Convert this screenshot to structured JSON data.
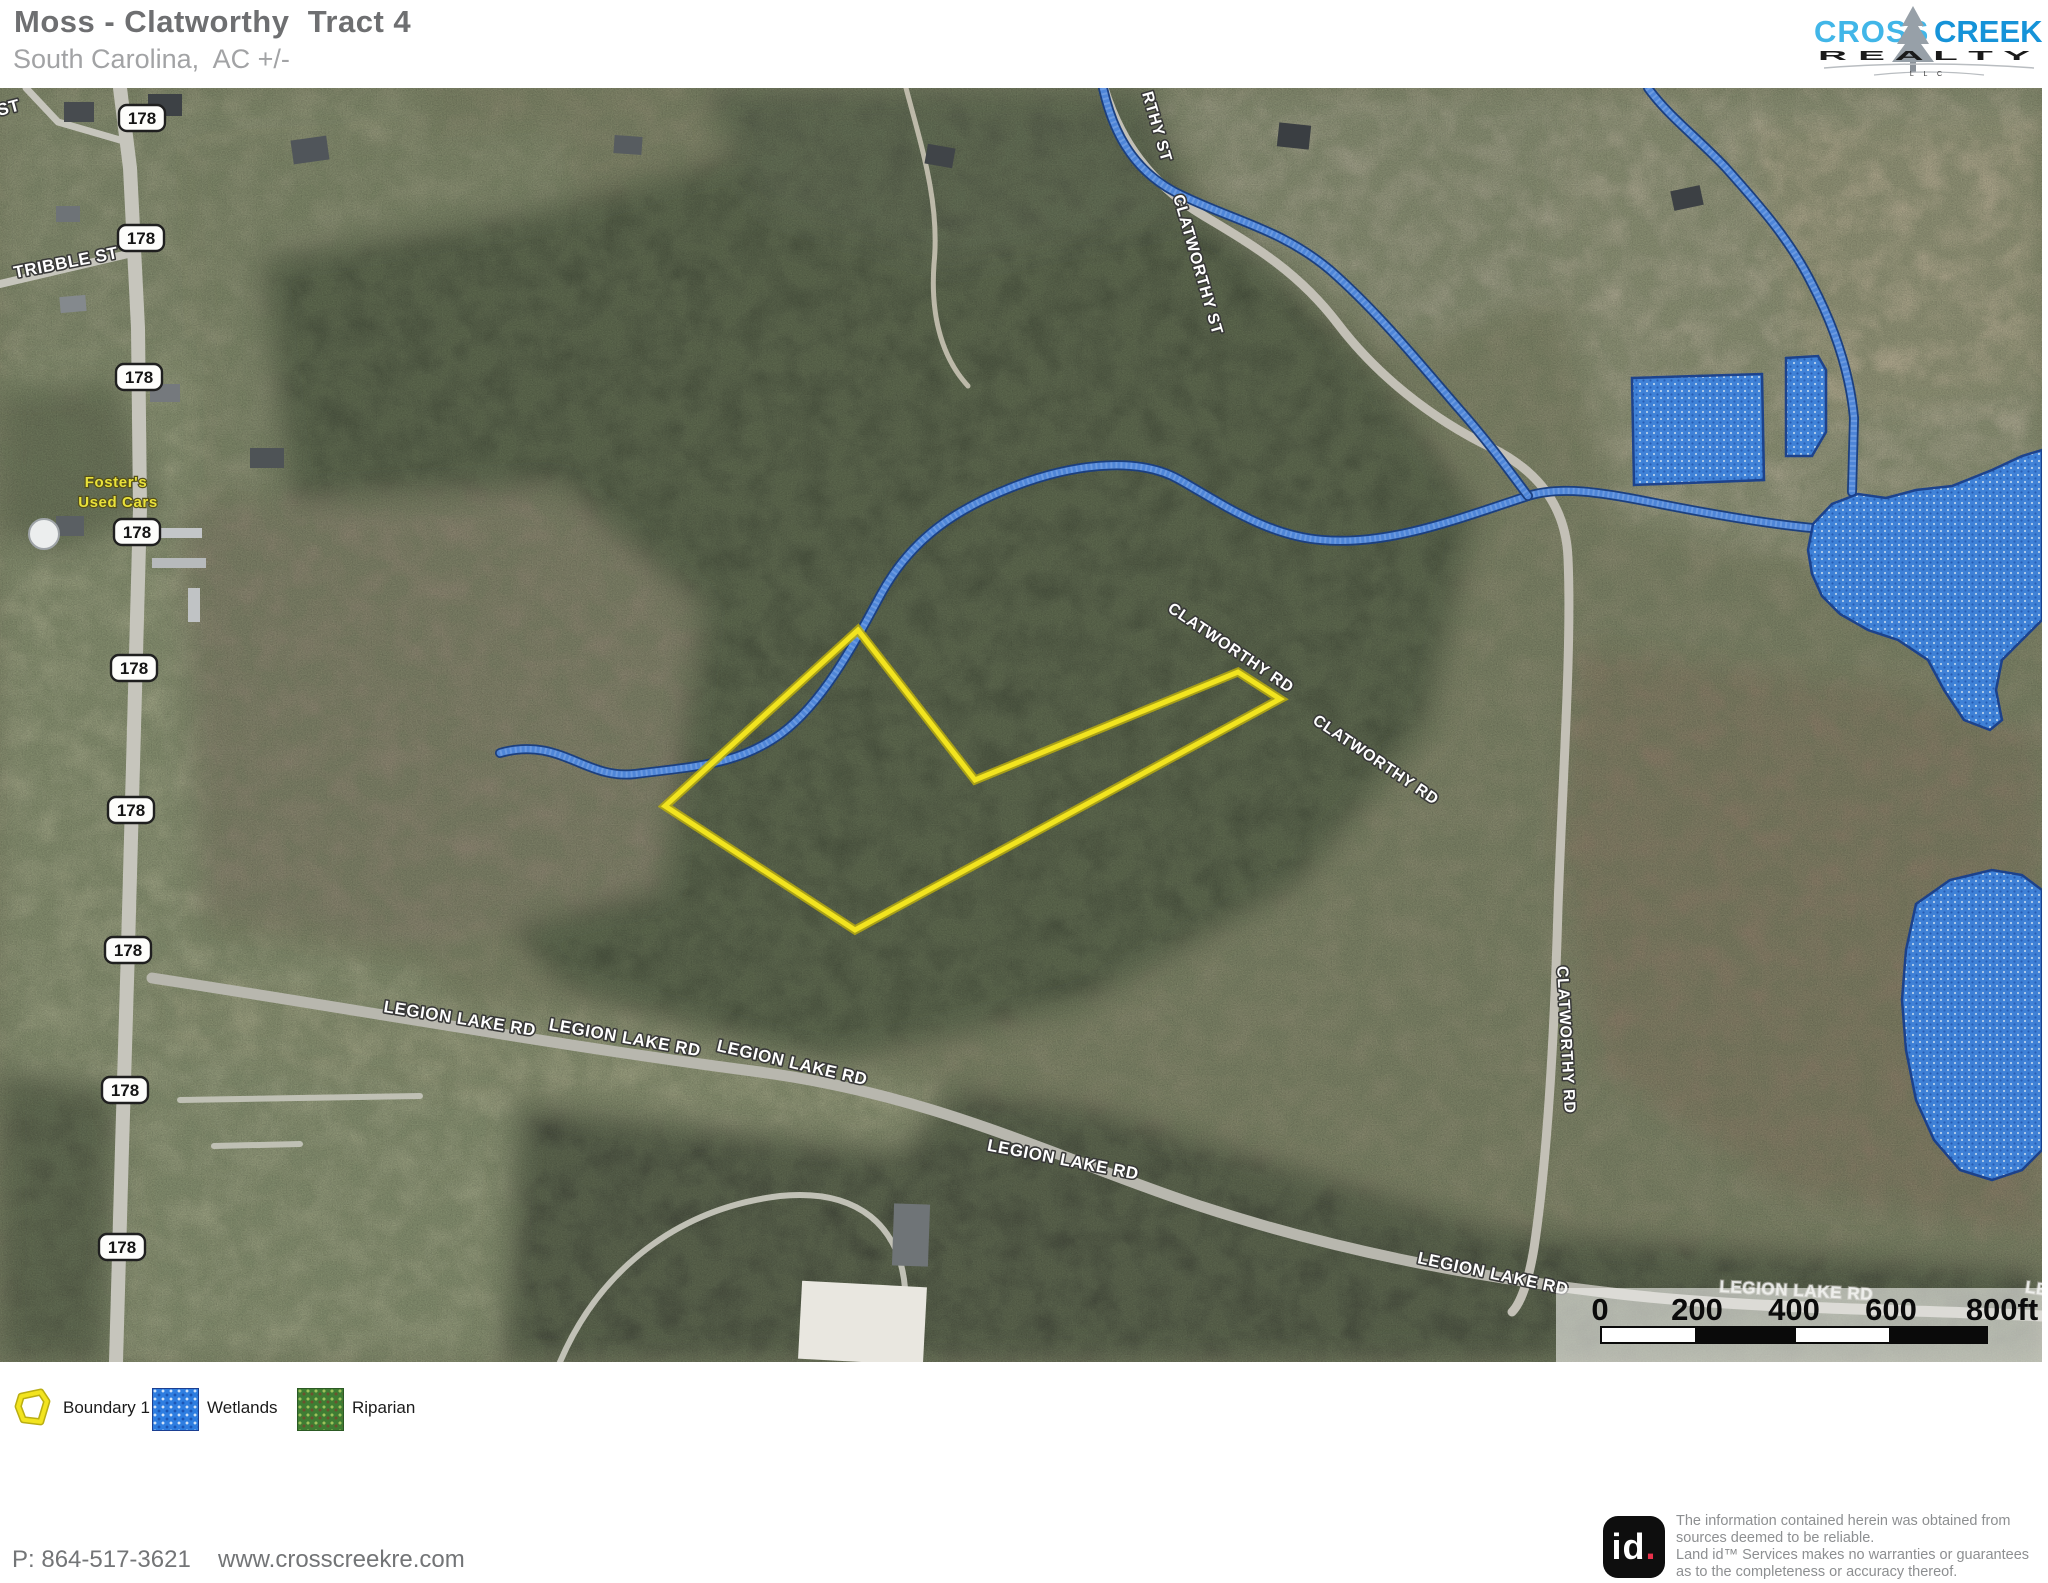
{
  "header": {
    "title": "Moss - Clatworthy  Tract 4",
    "subtitle": "South Carolina,  AC +/-"
  },
  "logo": {
    "cross": "CROSS",
    "creek": "CREEK",
    "realty": "R  E  A  L  T  Y",
    "llc": "L L C"
  },
  "colors": {
    "boundary": "#f2e41f",
    "boundary_casing": "#b7ab10",
    "wetland_fill": "#3b82e0",
    "wetland_stroke": "#163e8f",
    "stream": "#4f86d8",
    "stream_dark": "#1c3f7e",
    "riparian_fill": "#3f7d33",
    "logo_cross": "#41b6e8",
    "logo_creek": "#1693d8",
    "title_color": "#6e6f71",
    "subtitle_color": "#a2a3a5"
  },
  "map": {
    "route_shield": "178",
    "shield_positions": [
      [
        142,
        30
      ],
      [
        141,
        150
      ],
      [
        139,
        289
      ],
      [
        137,
        444
      ],
      [
        134,
        580
      ],
      [
        131,
        722
      ],
      [
        128,
        862
      ],
      [
        125,
        1002
      ],
      [
        122,
        1159
      ]
    ],
    "terrain": [
      {
        "pts": [
          [
            0,
            0
          ],
          [
            2042,
            0
          ],
          [
            2042,
            1274
          ],
          [
            0,
            1274
          ]
        ],
        "fill": "#8a8a70"
      },
      {
        "pts": [
          [
            0,
            0
          ],
          [
            195,
            0
          ],
          [
            205,
            640
          ],
          [
            190,
            1274
          ],
          [
            0,
            1274
          ]
        ],
        "fill": "#9da283"
      },
      {
        "pts": [
          [
            0,
            0
          ],
          [
            420,
            0
          ],
          [
            430,
            180
          ],
          [
            240,
            260
          ],
          [
            0,
            280
          ]
        ],
        "fill": "#94987b"
      },
      {
        "pts": [
          [
            190,
            60
          ],
          [
            560,
            40
          ],
          [
            620,
            300
          ],
          [
            400,
            420
          ],
          [
            210,
            400
          ]
        ],
        "fill": "#8f9377"
      },
      {
        "pts": [
          [
            0,
            300
          ],
          [
            120,
            290
          ],
          [
            160,
            420
          ],
          [
            60,
            470
          ],
          [
            0,
            450
          ]
        ],
        "fill": "#6a7158"
      },
      {
        "pts": [
          [
            260,
            170
          ],
          [
            540,
            120
          ],
          [
            760,
            60
          ],
          [
            980,
            140
          ],
          [
            1120,
            60
          ],
          [
            1260,
            160
          ],
          [
            1380,
            280
          ],
          [
            1480,
            420
          ],
          [
            1430,
            640
          ],
          [
            1300,
            800
          ],
          [
            1080,
            920
          ],
          [
            820,
            980
          ],
          [
            560,
            900
          ],
          [
            380,
            700
          ],
          [
            290,
            430
          ]
        ],
        "fill": "#4e5643"
      },
      {
        "pts": [
          [
            700,
            0
          ],
          [
            1150,
            0
          ],
          [
            1200,
            130
          ],
          [
            950,
            180
          ],
          [
            760,
            120
          ]
        ],
        "fill": "#59614e"
      },
      {
        "pts": [
          [
            1150,
            0
          ],
          [
            1620,
            0
          ],
          [
            1640,
            180
          ],
          [
            1400,
            260
          ],
          [
            1230,
            140
          ]
        ],
        "fill": "#a1a089"
      },
      {
        "pts": [
          [
            1560,
            0
          ],
          [
            2042,
            0
          ],
          [
            2042,
            430
          ],
          [
            1800,
            470
          ],
          [
            1620,
            430
          ],
          [
            1560,
            200
          ]
        ],
        "fill": "#a8a58d"
      },
      {
        "pts": [
          [
            1750,
            40
          ],
          [
            2042,
            30
          ],
          [
            2042,
            300
          ],
          [
            1820,
            330
          ]
        ],
        "fill": "#b2aa90"
      },
      {
        "pts": [
          [
            180,
            420
          ],
          [
            560,
            400
          ],
          [
            700,
            520
          ],
          [
            660,
            800
          ],
          [
            420,
            860
          ],
          [
            200,
            820
          ]
        ],
        "fill": "#8d8672"
      },
      {
        "pts": [
          [
            1580,
            560
          ],
          [
            1900,
            600
          ],
          [
            2042,
            650
          ],
          [
            2042,
            1150
          ],
          [
            1780,
            1100
          ],
          [
            1600,
            980
          ],
          [
            1560,
            760
          ]
        ],
        "fill": "#8b7e69"
      },
      {
        "pts": [
          [
            340,
            1000
          ],
          [
            700,
            960
          ],
          [
            1100,
            1020
          ],
          [
            1500,
            1140
          ],
          [
            2042,
            1180
          ],
          [
            2042,
            1274
          ],
          [
            360,
            1274
          ],
          [
            300,
            1120
          ]
        ],
        "fill": "#485040"
      },
      {
        "pts": [
          [
            140,
            840
          ],
          [
            420,
            880
          ],
          [
            520,
            980
          ],
          [
            500,
            1274
          ],
          [
            150,
            1274
          ]
        ],
        "fill": "#9ba182"
      },
      {
        "pts": [
          [
            150,
            880
          ],
          [
            600,
            930
          ],
          [
            950,
            1000
          ],
          [
            900,
            1060
          ],
          [
            500,
            1010
          ],
          [
            160,
            950
          ]
        ],
        "fill": "#a0a384"
      },
      {
        "pts": [
          [
            0,
            980
          ],
          [
            120,
            1000
          ],
          [
            110,
            1274
          ],
          [
            0,
            1274
          ]
        ],
        "fill": "#565d4a"
      }
    ],
    "roads": [
      {
        "d": "M120,0 L130,80 L138,240 L140,420 L134,640 L128,860 L122,1060 L116,1274",
        "w": 14,
        "c": "#c6c5bc"
      },
      {
        "d": "M152,890 C360,922 560,958 760,984 C940,1008 1060,1072 1200,1118 C1340,1164 1480,1190 1620,1206 C1760,1222 1940,1222 2042,1228",
        "w": 11,
        "c": "#b8b7ae"
      },
      {
        "d": "M1104,0 C1120,52 1150,96 1204,128 C1258,160 1300,186 1338,236 C1376,286 1430,330 1492,360 C1540,384 1566,420 1568,470 C1572,560 1562,700 1558,820 C1554,960 1546,1080 1534,1160 C1528,1196 1520,1216 1512,1224",
        "w": 9,
        "c": "#c3c0b6"
      },
      {
        "d": "M0,196 L128,166",
        "w": 8,
        "c": "#c6c5bc"
      },
      {
        "d": "M26,0 L58,34 L120,52",
        "w": 7,
        "c": "#c6c5bc"
      },
      {
        "d": "M560,1274 C600,1180 680,1120 780,1108 C860,1100 900,1140 905,1200",
        "w": 6,
        "c": "#cdccc2",
        "op": 0.9
      },
      {
        "d": "M906,0 C922,60 940,116 934,176 C930,232 944,272 968,298",
        "w": 5,
        "c": "#cfc9ba",
        "op": 0.85
      },
      {
        "d": "M180,1012 L420,1008 M214,1058 L300,1056",
        "w": 6,
        "c": "#c7c6bd",
        "op": 0.9
      }
    ],
    "buildings": [
      [
        64,
        14,
        30,
        20,
        0,
        "#474b4f"
      ],
      [
        148,
        6,
        34,
        22,
        0,
        "#3d4145"
      ],
      [
        292,
        50,
        36,
        24,
        -8,
        "#50555a"
      ],
      [
        614,
        48,
        28,
        18,
        4,
        "#575c60"
      ],
      [
        926,
        58,
        28,
        20,
        10,
        "#404448"
      ],
      [
        1278,
        36,
        32,
        24,
        6,
        "#3a3e42"
      ],
      [
        56,
        118,
        24,
        16,
        0,
        "#6e7377"
      ],
      [
        150,
        296,
        30,
        18,
        0,
        "#75797d"
      ],
      [
        60,
        208,
        26,
        16,
        -5,
        "#84898d"
      ],
      [
        56,
        428,
        28,
        20,
        0,
        "#5a5f63"
      ],
      [
        250,
        360,
        34,
        20,
        0,
        "#4e5356"
      ],
      [
        1672,
        100,
        30,
        20,
        -12,
        "#3c4044"
      ],
      [
        800,
        1196,
        125,
        78,
        3,
        "#e9e7e0"
      ],
      [
        893,
        1116,
        36,
        62,
        2,
        "#6f7477"
      ],
      [
        150,
        440,
        52,
        10,
        0,
        "#c3c6c8"
      ],
      [
        152,
        470,
        54,
        10,
        0,
        "#b7babc"
      ],
      [
        188,
        500,
        12,
        34,
        0,
        "#c0c3c5"
      ]
    ],
    "water_tower": [
      44,
      446,
      15
    ],
    "streams": [
      "M500,665 C560,648 585,692 635,686 C700,678 740,676 782,645 C822,615 852,560 880,508 C912,448 960,420 1010,400 C1065,378 1135,366 1180,392 C1222,416 1268,448 1322,452 C1390,458 1460,430 1528,408 C1560,398 1600,404 1650,414 C1710,426 1770,436 1812,440",
      "M1103,0 C1112,40 1130,80 1175,104 C1230,132 1280,140 1330,182 C1380,226 1420,276 1460,322 C1490,356 1510,384 1528,408",
      "M1648,0 C1668,28 1700,52 1726,80 C1760,118 1790,152 1812,196 C1836,242 1850,286 1854,330 L1852,404"
    ],
    "wetlands": [
      [
        [
          1632,
          290
        ],
        [
          1762,
          286
        ],
        [
          1764,
          392
        ],
        [
          1634,
          397
        ]
      ],
      [
        [
          1786,
          270
        ],
        [
          1818,
          268
        ],
        [
          1826,
          282
        ],
        [
          1826,
          344
        ],
        [
          1812,
          368
        ],
        [
          1786,
          368
        ]
      ],
      [
        [
          1808,
          462
        ],
        [
          1813,
          436
        ],
        [
          1832,
          416
        ],
        [
          1858,
          406
        ],
        [
          1886,
          410
        ],
        [
          1916,
          402
        ],
        [
          1952,
          398
        ],
        [
          1992,
          382
        ],
        [
          2022,
          368
        ],
        [
          2042,
          362
        ],
        [
          2042,
          532
        ],
        [
          2022,
          552
        ],
        [
          2002,
          572
        ],
        [
          1996,
          602
        ],
        [
          2002,
          632
        ],
        [
          1990,
          642
        ],
        [
          1964,
          632
        ],
        [
          1944,
          602
        ],
        [
          1928,
          572
        ],
        [
          1898,
          552
        ],
        [
          1868,
          542
        ],
        [
          1840,
          526
        ],
        [
          1822,
          508
        ],
        [
          1812,
          486
        ]
      ],
      [
        [
          1916,
          816
        ],
        [
          1950,
          792
        ],
        [
          1992,
          782
        ],
        [
          2022,
          787
        ],
        [
          2042,
          802
        ],
        [
          2042,
          1062
        ],
        [
          2022,
          1082
        ],
        [
          1992,
          1092
        ],
        [
          1960,
          1082
        ],
        [
          1934,
          1052
        ],
        [
          1916,
          1012
        ],
        [
          1906,
          962
        ],
        [
          1902,
          912
        ],
        [
          1906,
          862
        ]
      ]
    ],
    "boundary": [
      [
        858,
        542
      ],
      [
        975,
        692
      ],
      [
        1238,
        584
      ],
      [
        1280,
        611
      ],
      [
        855,
        842
      ],
      [
        665,
        718
      ]
    ],
    "labels": [
      {
        "t": "ST",
        "x": 10,
        "y": 25,
        "r": -15,
        "s": 17
      },
      {
        "t": "TRIBBLE ST",
        "x": 67,
        "y": 180,
        "r": -11,
        "s": 17
      },
      {
        "t": "Foster's",
        "x": 116,
        "y": 399,
        "r": 0,
        "s": 15,
        "c": "poi"
      },
      {
        "t": "Used Cars",
        "x": 118,
        "y": 419,
        "r": 0,
        "s": 15,
        "c": "poi"
      },
      {
        "t": "RTHY ST",
        "x": 1152,
        "y": 40,
        "r": 74,
        "s": 16
      },
      {
        "t": "CLATWORTHY ST",
        "x": 1193,
        "y": 178,
        "r": 74,
        "s": 16
      },
      {
        "t": "CLATWORTHY RD",
        "x": 1228,
        "y": 564,
        "r": 34,
        "s": 16
      },
      {
        "t": "CLATWORTHY RD",
        "x": 1373,
        "y": 676,
        "r": 34,
        "s": 16
      },
      {
        "t": "CLATWORTHY RD",
        "x": 1561,
        "y": 952,
        "r": 87,
        "s": 16
      },
      {
        "t": "LEGION LAKE RD",
        "x": 459,
        "y": 936,
        "r": 9,
        "s": 17
      },
      {
        "t": "LEGION LAKE RD",
        "x": 624,
        "y": 955,
        "r": 10,
        "s": 17
      },
      {
        "t": "LEGION LAKE RD",
        "x": 791,
        "y": 980,
        "r": 13,
        "s": 17
      },
      {
        "t": "LEGION LAKE RD",
        "x": 1062,
        "y": 1077,
        "r": 11,
        "s": 17
      },
      {
        "t": "LEGION LAKE RD",
        "x": 1492,
        "y": 1191,
        "r": 12,
        "s": 17
      },
      {
        "t": "LEGION LAKE RD",
        "x": 1796,
        "y": 1208,
        "r": 3,
        "s": 17,
        "c": "faint"
      },
      {
        "t": "LE",
        "x": 2036,
        "y": 1206,
        "r": 8,
        "s": 17,
        "c": "faint"
      }
    ],
    "scalebar": {
      "x": 1556,
      "y": 1200,
      "w": 486,
      "h": 74,
      "bar_x": 1600,
      "bar_y": 1238,
      "seg": 97,
      "bar_h": 18,
      "ticks": [
        "0",
        "200",
        "400",
        "600",
        "800ft"
      ]
    }
  },
  "legend": {
    "items": [
      {
        "label": "Boundary 1",
        "type": "boundary"
      },
      {
        "label": "Wetlands",
        "type": "wetlands"
      },
      {
        "label": "Riparian",
        "type": "riparian"
      }
    ]
  },
  "footer": {
    "phone": "P: 864-517-3621",
    "website": "www.crosscreekre.com",
    "id_text": "id",
    "id_dot": ".",
    "disclaimer": [
      "The information contained herein was obtained from",
      "sources deemed to be reliable.",
      "Land id™ Services makes no warranties or guarantees",
      "as to the completeness or accuracy thereof."
    ]
  }
}
